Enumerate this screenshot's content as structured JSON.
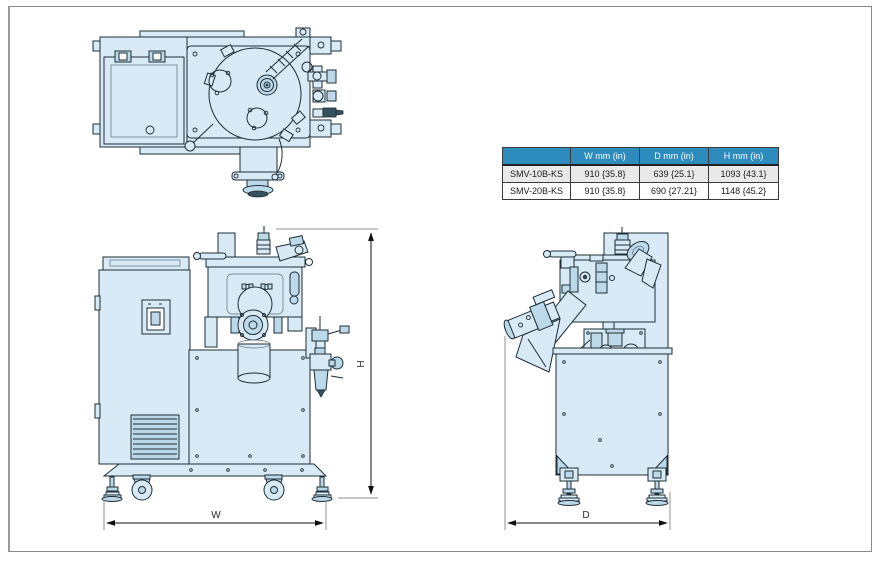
{
  "page": {
    "background": "#ffffff",
    "frame_border": "#8a8a8a"
  },
  "drawing": {
    "fill": "#d7eaf5",
    "fill_shaded": "#bcd9ea",
    "outline": "#1e2d36",
    "labels": {
      "width": "W",
      "height": "H",
      "depth": "D"
    }
  },
  "spec_table": {
    "header_bg": "#2e8bbd",
    "header_text_color": "#ffffff",
    "alt_row_bg": "#e9e9e9",
    "corner": "",
    "columns": [
      "W mm (in)",
      "D mm (in)",
      "H mm (in)"
    ],
    "rows": [
      {
        "model": "SMV-10B-KS",
        "w": "910 {35.8}",
        "d": "639 {25.1}",
        "h": "1093 {43.1}"
      },
      {
        "model": "SMV-20B-KS",
        "w": "910 {35.8}",
        "d": "690 {27.21}",
        "h": "1148 {45.2}"
      }
    ]
  }
}
